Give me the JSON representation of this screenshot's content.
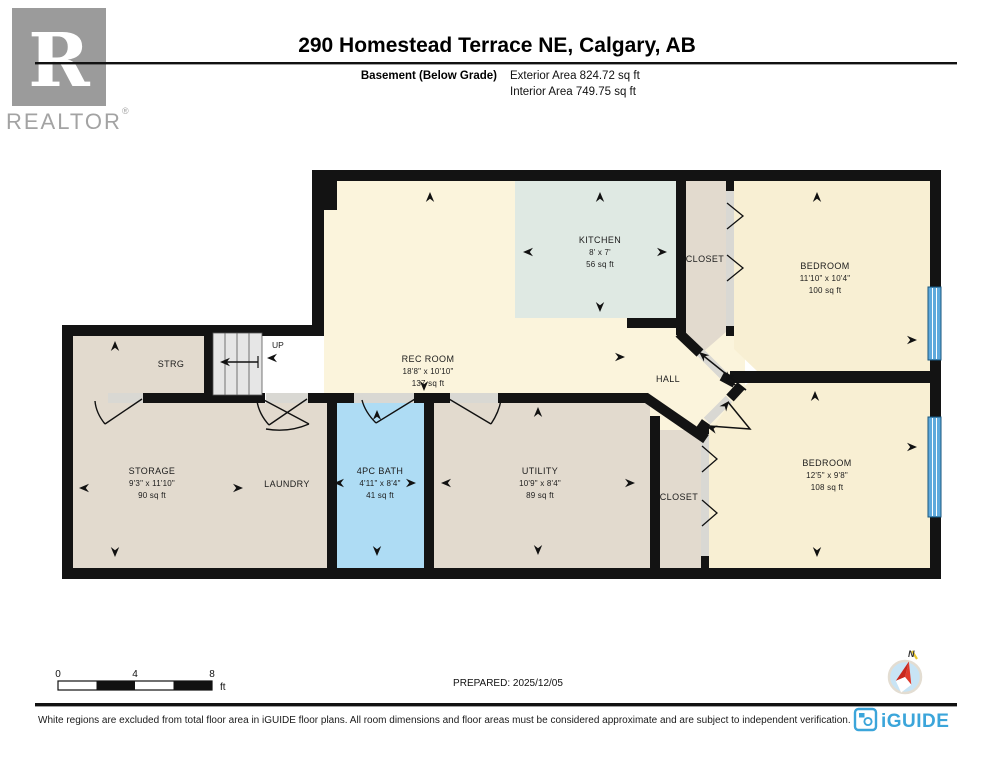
{
  "header": {
    "title": "290 Homestead Terrace NE, Calgary, AB",
    "floor_label": "Basement (Below Grade)",
    "exterior_area": "Exterior Area 824.72 sq ft",
    "interior_area": "Interior Area 749.75 sq ft"
  },
  "branding": {
    "realtor_logo_letter": "R",
    "realtor_wordmark": "REALTOR",
    "registered_mark": "®",
    "iguide_wordmark": "iGUIDE"
  },
  "rooms": {
    "rec_room": {
      "name": "REC ROOM",
      "dims": "18'8\" x 10'10\"",
      "area": "137 sq ft"
    },
    "kitchen": {
      "name": "KITCHEN",
      "dims": "8' x 7'",
      "area": "56 sq ft"
    },
    "closet_top": {
      "name": "CLOSET"
    },
    "bedroom_top": {
      "name": "BEDROOM",
      "dims": "11'10\" x 10'4\"",
      "area": "100 sq ft"
    },
    "strg": {
      "name": "STRG"
    },
    "hall": {
      "name": "HALL"
    },
    "stairs": {
      "label": "UP"
    },
    "storage": {
      "name": "STORAGE",
      "dims": "9'3\" x 11'10\"",
      "area": "90 sq ft"
    },
    "laundry": {
      "name": "LAUNDRY"
    },
    "bath": {
      "name": "4PC BATH",
      "dims": "4'11\" x 8'4\"",
      "area": "41 sq ft"
    },
    "utility": {
      "name": "UTILITY",
      "dims": "10'9\" x 8'4\"",
      "area": "89 sq ft"
    },
    "closet_bottom": {
      "name": "CLOSET"
    },
    "bedroom_bottom": {
      "name": "BEDROOM",
      "dims": "12'5\" x 9'8\"",
      "area": "108 sq ft"
    }
  },
  "scale_bar": {
    "tick_0": "0",
    "tick_4": "4",
    "tick_8": "8",
    "unit": "ft"
  },
  "prepared_label": "PREPARED: 2025/12/05",
  "compass": {
    "north_label": "N"
  },
  "footer": {
    "disclaimer": "White regions are excluded from total floor area in iGUIDE floor plans. All room dimensions and floor areas must be considered approximate and are subject to independent verification."
  },
  "colors": {
    "wall": "#131313",
    "room_cream": "#FBF4DC",
    "room_cream_warm": "#F8EFD3",
    "kitchen_teal": "#DFE9E3",
    "room_tan": "#E2DACE",
    "bath_blue": "#AEDCF4",
    "window_blue": "#5FA9DC",
    "opening_gray": "#D9D8D3",
    "stairs_gray": "#E6E6E6",
    "brand_blue": "#3BA5DA",
    "logo_gray": "#9B9B9B"
  }
}
